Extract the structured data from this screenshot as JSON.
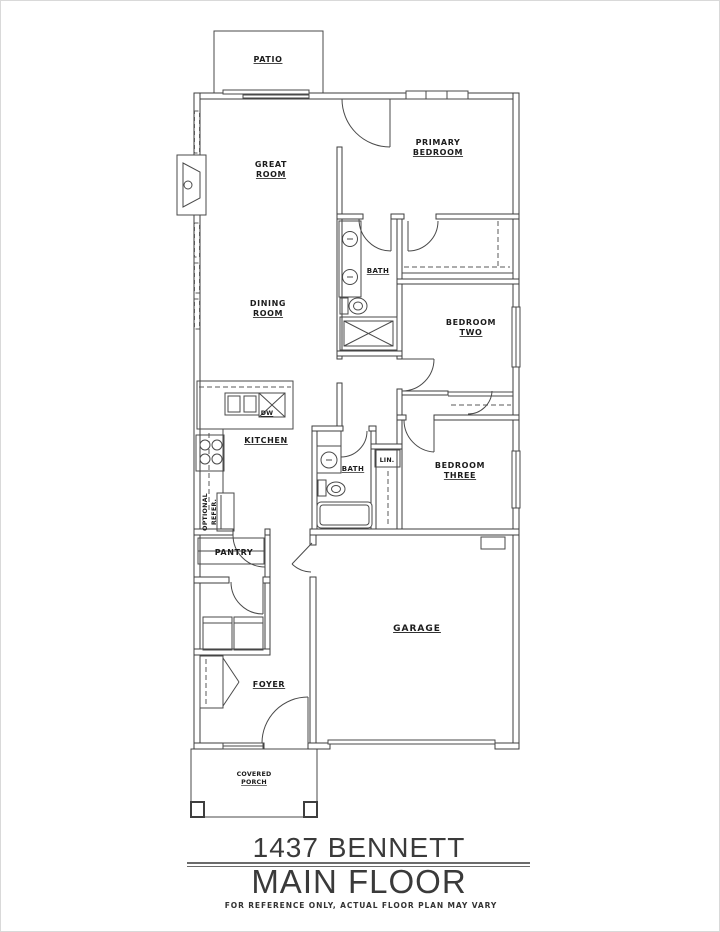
{
  "labels": {
    "patio": "PATIO",
    "great_room": {
      "l1": "GREAT",
      "l2": "ROOM"
    },
    "primary_bedroom": {
      "l1": "PRIMARY",
      "l2": "BEDROOM"
    },
    "bath_primary": "BATH",
    "dining_room": {
      "l1": "DINING",
      "l2": "ROOM"
    },
    "bedroom_two": {
      "l1": "BEDROOM",
      "l2": "TWO"
    },
    "kitchen": "KITCHEN",
    "dishwasher": "DW",
    "optional_refer": {
      "l1": "OPTIONAL",
      "l2": "REFER."
    },
    "bath_hall": "BATH",
    "linen": "LIN.",
    "bedroom_three": {
      "l1": "BEDROOM",
      "l2": "THREE"
    },
    "pantry": "PANTRY",
    "foyer": "FOYER",
    "garage": "GARAGE",
    "covered_porch": {
      "l1": "COVERED",
      "l2": "PORCH"
    }
  },
  "title_block": {
    "address": "1437 BENNETT",
    "floor": "MAIN FLOOR",
    "disclaimer": "FOR REFERENCE ONLY, ACTUAL FLOOR PLAN MAY VARY"
  },
  "colors": {
    "background": "#ffffff",
    "wall_line": "#3e3e3e",
    "detail_line": "#4a4a4a",
    "label_text": "#1c1c1c",
    "title_text": "#3a3a3a"
  }
}
